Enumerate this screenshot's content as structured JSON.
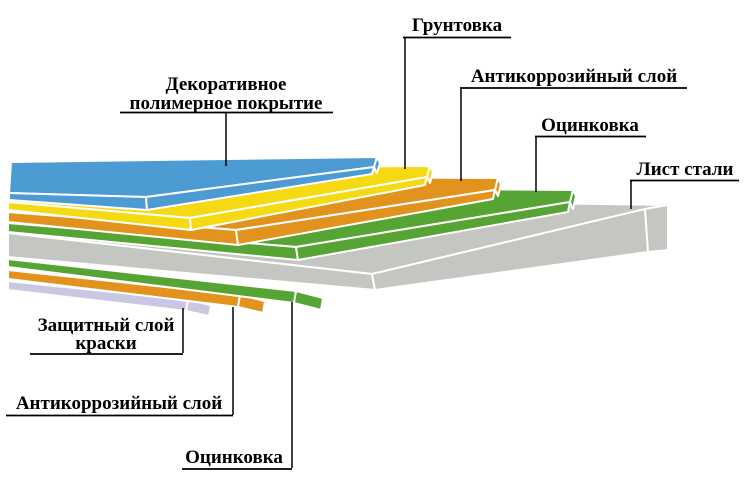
{
  "diagram": {
    "description": "Структура листа стали с покрытием (layer structure of coated sheet steel)",
    "background": "#ffffff",
    "connector_color": "#000000",
    "text_color": "#000000",
    "seam_color": "#ffffff"
  },
  "materials": {
    "polymer": {
      "name": "Декоративное полимерное покрытие",
      "color": "#4C9CD3"
    },
    "primer": {
      "name": "Грунтовка",
      "color": "#F5DA13"
    },
    "anticorrosion": {
      "name": "Антикоррозийный слой",
      "color": "#E2931E"
    },
    "zinc": {
      "name": "Оцинковка",
      "color": "#55A434"
    },
    "steel": {
      "name": "Лист стали",
      "color": "#C4C6C1"
    },
    "paint": {
      "name": "Защитный слой краски",
      "color": "#C9C8E3"
    }
  },
  "callouts": [
    {
      "id": "polymer",
      "lines": [
        "Декоративное",
        "полимерное покрытие"
      ]
    },
    {
      "id": "primer",
      "lines": [
        "Грунтовка"
      ]
    },
    {
      "id": "anticorrosion_top",
      "lines": [
        "Антикоррозийный слой"
      ]
    },
    {
      "id": "zinc_top",
      "lines": [
        "Оцинковка"
      ]
    },
    {
      "id": "steel",
      "lines": [
        "Лист стали"
      ]
    },
    {
      "id": "paint",
      "lines": [
        "Защитный слой",
        "краски"
      ]
    },
    {
      "id": "anticorrosion_bottom",
      "lines": [
        "Антикоррозийный слой"
      ]
    },
    {
      "id": "zinc_bottom",
      "lines": [
        "Оцинковка"
      ]
    }
  ]
}
